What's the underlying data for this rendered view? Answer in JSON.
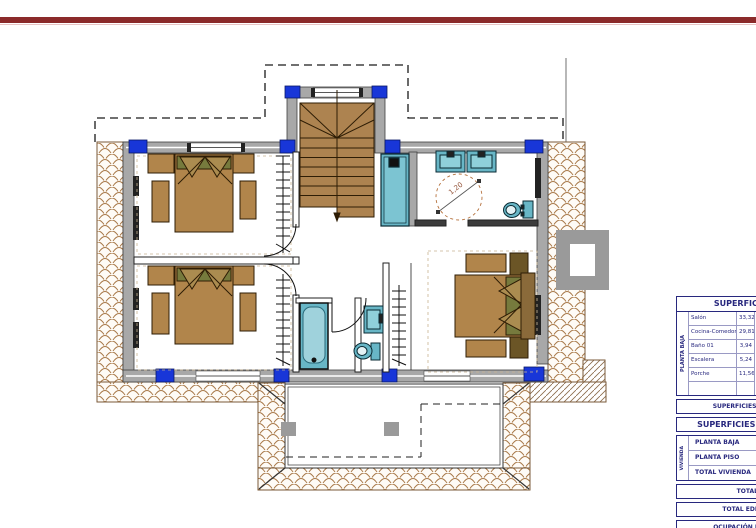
{
  "page": {
    "top_bar_color": "#8b2a2a",
    "background": "#ffffff"
  },
  "plan": {
    "turning_circle_label": "1,20"
  },
  "tables": {
    "superficies_utiles": {
      "title": "SUPERFICIES ÚTILES",
      "groups": [
        {
          "label": "PLANTA BAJA",
          "rows": [
            [
              "Salón",
              "33,32"
            ],
            [
              "Cocina-Comedor",
              "29,81"
            ],
            [
              "Baño 01",
              "3,94"
            ],
            [
              "Escalera",
              "5,24"
            ],
            [
              "Porche",
              "11,56"
            ],
            [
              "",
              ""
            ]
          ]
        },
        {
          "label": "PLANTA PISO",
          "rows": [
            [
              "Dormitorio",
              ""
            ],
            [
              "Baño 02",
              ""
            ],
            [
              "Baño 03",
              ""
            ],
            [
              "Dormitorio",
              ""
            ],
            [
              "Dormitorio",
              ""
            ],
            [
              "Paso",
              ""
            ]
          ]
        }
      ],
      "total": "SUPERFICIES ÚTIL TOTAL 12"
    },
    "superficies_construidas": {
      "title": "SUPERFICIES CONSTRUIDAS",
      "vivienda_label": "VIVIENDA",
      "vivienda_rows": [
        "PLANTA BAJA",
        "PLANTA PISO",
        "TOTAL VIVIENDA"
      ],
      "rows": [
        "TOTAL ANEXO",
        "TOTAL EDIFICACIONES",
        "OCUPACIÓN EDIFICACIONES",
        "LÁMINA AGUA PISCINA"
      ]
    }
  }
}
